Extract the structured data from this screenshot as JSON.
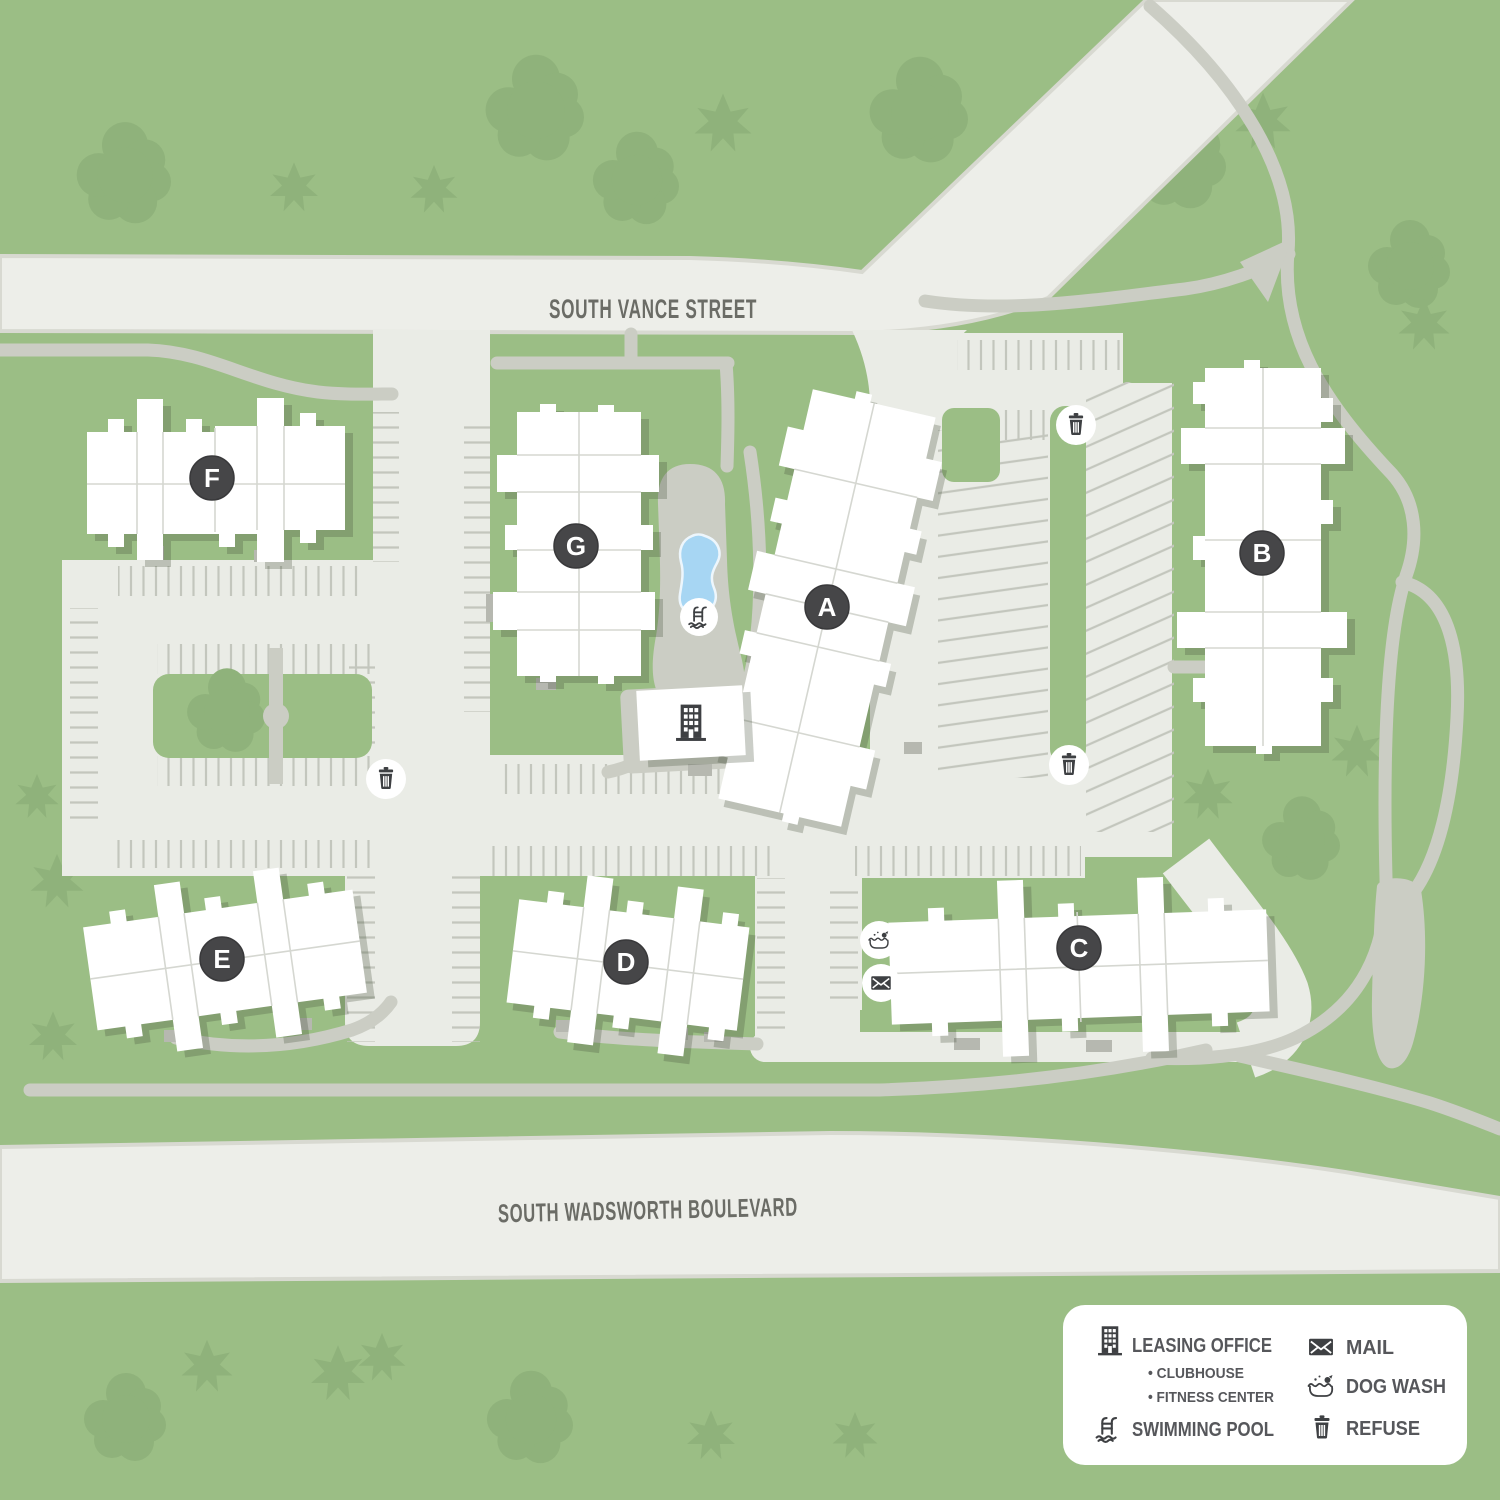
{
  "map": {
    "streets": [
      {
        "name": "SOUTH VANCE STREET"
      },
      {
        "name": "SOUTH WADSWORTH BOULEVARD"
      }
    ],
    "buildings": [
      {
        "letter": "A"
      },
      {
        "letter": "B"
      },
      {
        "letter": "C"
      },
      {
        "letter": "D"
      },
      {
        "letter": "E"
      },
      {
        "letter": "F"
      },
      {
        "letter": "G"
      }
    ],
    "amenity_icons": {
      "pool": "pool-ladder-icon",
      "refuse": "trash-can-icon",
      "mail": "envelope-icon",
      "dog_wash": "dog-bath-icon",
      "leasing_office": "building-icon"
    },
    "colors": {
      "grass": "#9BBE85",
      "tree": "#8FB27B",
      "street": "#EDEEE9",
      "street_edge": "#D8D9D1",
      "lot": "#EAECE6",
      "path": "#CBCDC4",
      "stall_line": "#C3C6BD",
      "building": "#FFFFFF",
      "badge": "#464648",
      "pool_water": "#A7D6F3",
      "street_text": "#6B6C66",
      "legend_text": "#56575B",
      "icon": "#3E4043"
    }
  },
  "legend": {
    "left": [
      {
        "icon": "building-icon",
        "label": "LEASING OFFICE",
        "subs": [
          "• CLUBHOUSE",
          "• FITNESS CENTER"
        ]
      },
      {
        "icon": "pool-ladder-icon",
        "label": "SWIMMING POOL"
      }
    ],
    "right": [
      {
        "icon": "envelope-icon",
        "label": "MAIL"
      },
      {
        "icon": "dog-bath-icon",
        "label": "DOG WASH"
      },
      {
        "icon": "trash-can-icon",
        "label": "REFUSE"
      }
    ]
  }
}
